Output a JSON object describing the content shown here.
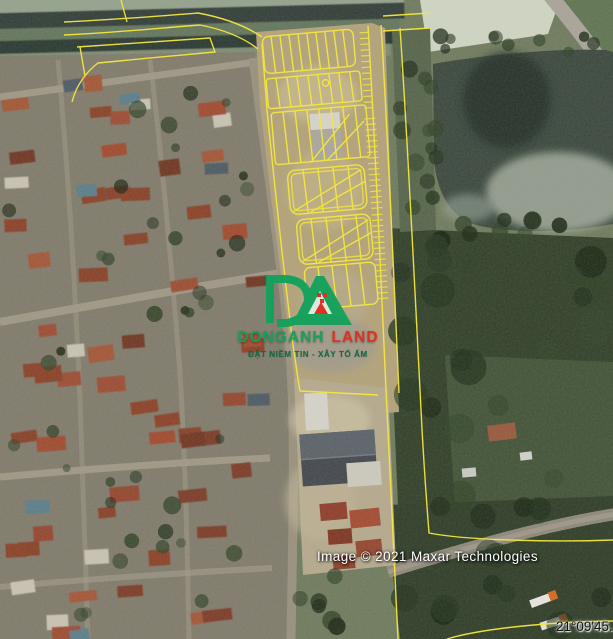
{
  "map": {
    "attribution": "Image © 2021 Maxar Technologies",
    "coordinates_label": "21°09'45.",
    "overlay_color": "#f2e73e"
  },
  "watermark": {
    "brand_first": "DONGANH",
    "brand_second": "LAND",
    "tagline": "ĐẶT NIỀM TIN - XÂY TỔ ẤM",
    "brand_green": "#12a15b",
    "brand_red": "#e22b1f",
    "logo_icon": "dong-anh-land-monogram"
  }
}
